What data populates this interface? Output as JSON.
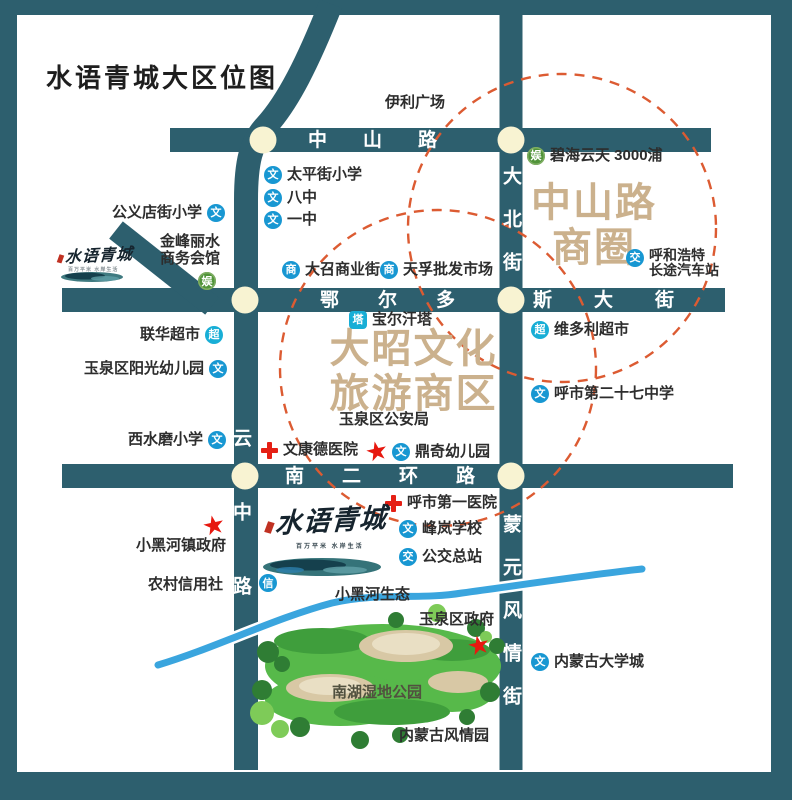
{
  "title": "水语青城大区位图",
  "legend_icons": {
    "school": "文",
    "commerce": "商",
    "supermarket": "超",
    "tower": "塔",
    "transit": "交",
    "entertainment": "娱",
    "credit": "信"
  },
  "roads": {
    "zhongshan": "中山路",
    "eerduosi_full": "鄂尔多斯大街",
    "eerduosi_left": "鄂尔多",
    "eerduosi_right": "斯大街",
    "nan_er_huan": "南二环路",
    "dabei": "大北街",
    "yunzhong": "云中路",
    "mengyuan": "蒙元风情街"
  },
  "districts": {
    "zhongshan_circle": {
      "line1": "中山路",
      "line2": "商圈"
    },
    "dazhao_zone": {
      "line1": "大昭文化",
      "line2": "旅游商区"
    }
  },
  "pois": {
    "yili_guangchang": "伊利广场",
    "taipingjie_xiaoxue": "太平街小学",
    "ba_zhong": "八中",
    "yi_zhong": "一中",
    "gongyidianjie_xiaoxue": "公义店街小学",
    "jinfeng_lishui": {
      "line1": "金峰丽水",
      "line2": "商务会馆"
    },
    "bihai_yuntian": "碧海云天  3000浦",
    "huhehaote_bus": {
      "line1": "呼和浩特",
      "line2": "长途汽车站"
    },
    "dazhao_shangyejie": "大召商业街",
    "tianfu_pifa": "天孚批发市场",
    "baoerhan_ta": "宝尔汗塔",
    "lianhua_chaoshi": "联华超市",
    "yangguang_youeryuan": "玉泉区阳光幼儿园",
    "weiduoli_chaoshi": "维多利超市",
    "no27_zhongxue": "呼市第二十七中学",
    "gonganju": "玉泉区公安局",
    "xishuimo_xiaoxue": "西水磨小学",
    "wenkangde_yiyuan": "文康德医院",
    "dingqi_youeryuan": "鼎奇幼儿园",
    "diyi_yiyuan": "呼市第一医院",
    "fenglan_xuexiao": "峰岚学校",
    "gongjiao_zongzhan": "公交总站",
    "xiaoheihe_zhengfu": "小黑河镇政府",
    "nongcun_xinyongshe": "农村信用社",
    "xiaoheihe_shengtai": "小黑河生态",
    "yuquanqu_zhengfu": "玉泉区政府",
    "neimenggu_daxuecheng": "内蒙古大学城",
    "nanhu_shidi": "南湖湿地公园",
    "neimenggu_fengqingyuan": "内蒙古风情园"
  },
  "logo": {
    "name": "水语青城",
    "tagline": "百万平米  水岸生活"
  },
  "colors": {
    "frame": "#2d5f6e",
    "road": "#2d5f6e",
    "junction_fill": "#f8f3d2",
    "dashed_circle": "#dc5b32",
    "river": "#3aa5de",
    "district_text": "#cbb18d",
    "icon_blue": "#1897d2",
    "icon_cyan": "#18aed6",
    "icon_green": "#51943a",
    "red_marker": "#e7180f",
    "park_green": "#57b94a"
  }
}
